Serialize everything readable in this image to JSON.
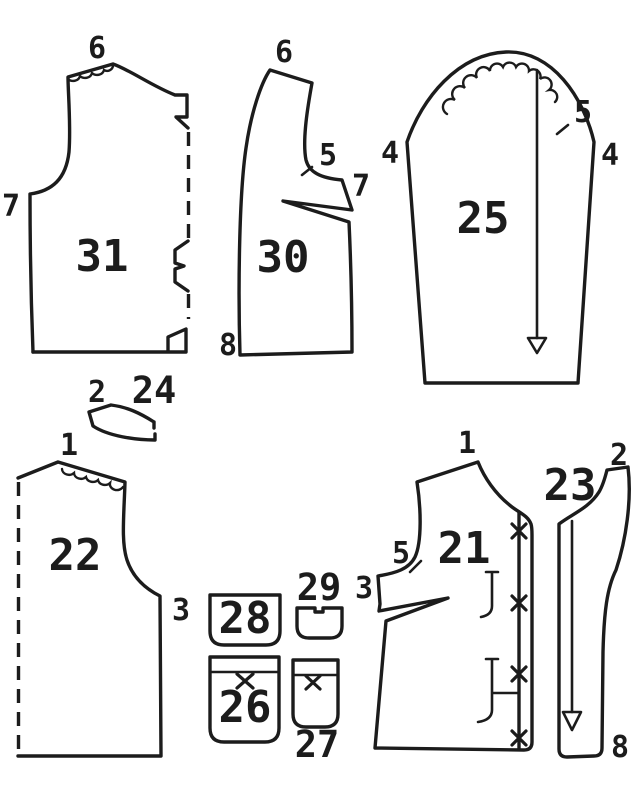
{
  "figure": {
    "description": "Sewing pattern cutting diagram with numbered pattern pieces",
    "background": "#ffffff",
    "ink": "#1c1c1c"
  },
  "pieces": {
    "p31": {
      "number": "31",
      "marks": {
        "shoulder": "6",
        "side": "7"
      }
    },
    "p30": {
      "number": "30",
      "marks": {
        "top": "6",
        "notch": "5",
        "corner": "7",
        "hem": "8"
      }
    },
    "p25": {
      "number": "25",
      "marks": {
        "left": "4",
        "right": "4",
        "notch": "5"
      }
    },
    "p24": {
      "number": "24",
      "marks": {
        "end": "2"
      }
    },
    "p22": {
      "number": "22",
      "marks": {
        "shoulder": "1",
        "side": "3"
      }
    },
    "p21": {
      "number": "21",
      "marks": {
        "shoulder": "1",
        "notch": "5",
        "side": "3"
      }
    },
    "p23": {
      "number": "23",
      "marks": {
        "top": "2",
        "hem": "8"
      }
    },
    "p28": {
      "number": "28"
    },
    "p29": {
      "number": "29"
    },
    "p26": {
      "number": "26"
    },
    "p27": {
      "number": "27"
    }
  }
}
